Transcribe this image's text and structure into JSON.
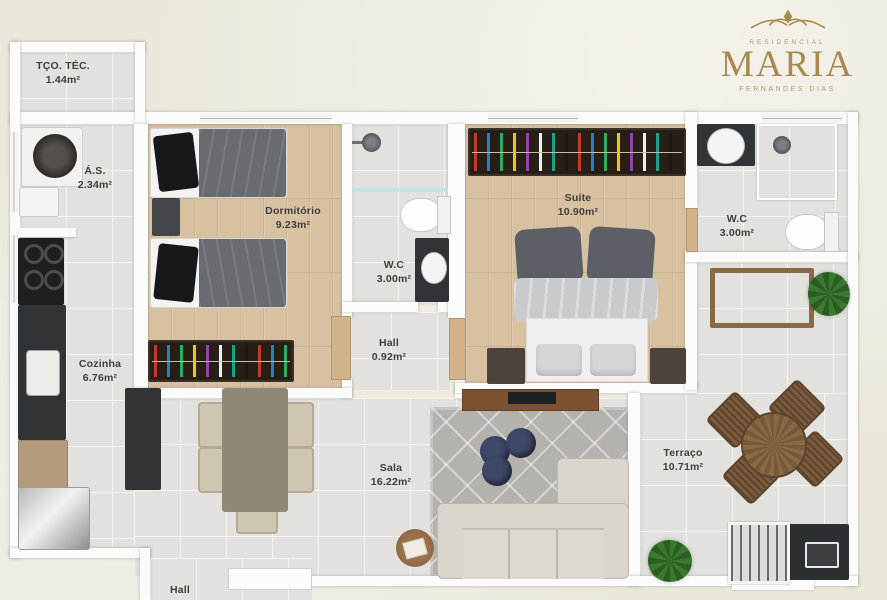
{
  "logo": {
    "line1": "RESIDENCIAL",
    "name": "MARIA",
    "line2": "FERNANDES DIAS"
  },
  "rooms": [
    {
      "name": "TÇO. TÉC.",
      "area": "1.44m²"
    },
    {
      "name": "Á.S.",
      "area": "2.34m²"
    },
    {
      "name": "Cozinha",
      "area": "6.76m²"
    },
    {
      "name": "Dormitório",
      "area": "9.23m²"
    },
    {
      "name": "W.C",
      "area": "3.00m²"
    },
    {
      "name": "Hall",
      "area": "0.92m²"
    },
    {
      "name": "Suíte",
      "area": "10.90m²"
    },
    {
      "name": "W.C",
      "area": "3.00m²"
    },
    {
      "name": "Sala",
      "area": "16.22m²"
    },
    {
      "name": "Terraço",
      "area": "10.71m²"
    },
    {
      "name": "Hall",
      "area": ""
    }
  ],
  "theme": {
    "bg": "#ebe8db",
    "wall": "#fbfbfb",
    "tile": "#e2e1de",
    "grout": "#f3f2ef",
    "wood": "#d8c1a1",
    "woodline": "rgba(146,112,76,.30)",
    "gold": "#a8894f",
    "goldlight": "#b79a6a",
    "label": "#3e3e3e",
    "counter": "#313437",
    "wardrobe": "#271f16",
    "navy": "#3e4968",
    "door": "#d2b28b",
    "sofa": "#d9d4cc",
    "rug": "#b5b2ad"
  }
}
